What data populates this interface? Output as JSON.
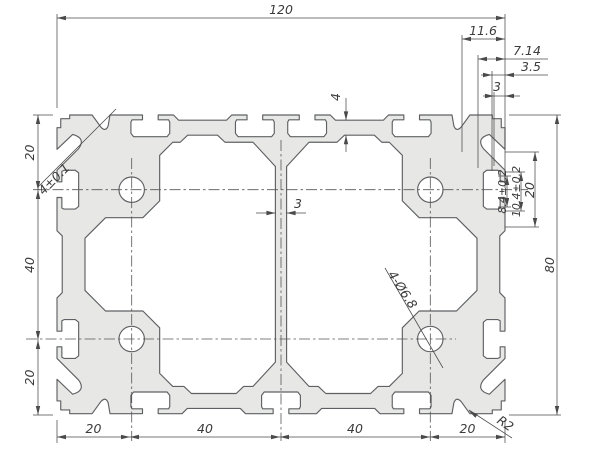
{
  "dims": {
    "overall_width": "120",
    "overall_height": "80",
    "top_right_details": [
      "11.6",
      "7.14",
      "3.5",
      "3"
    ],
    "left_chain": [
      "20",
      "40",
      "20"
    ],
    "bottom_chain": [
      "20",
      "40",
      "40",
      "20"
    ],
    "right_stack": [
      "8.4±0.2",
      "10.4±0.2",
      "20"
    ],
    "web_thickness": "3",
    "wall_thickness": "4",
    "corner_slot_width": "4±0.1",
    "corner_radius": "R2",
    "hole_callout": "4-Ø6.8"
  }
}
